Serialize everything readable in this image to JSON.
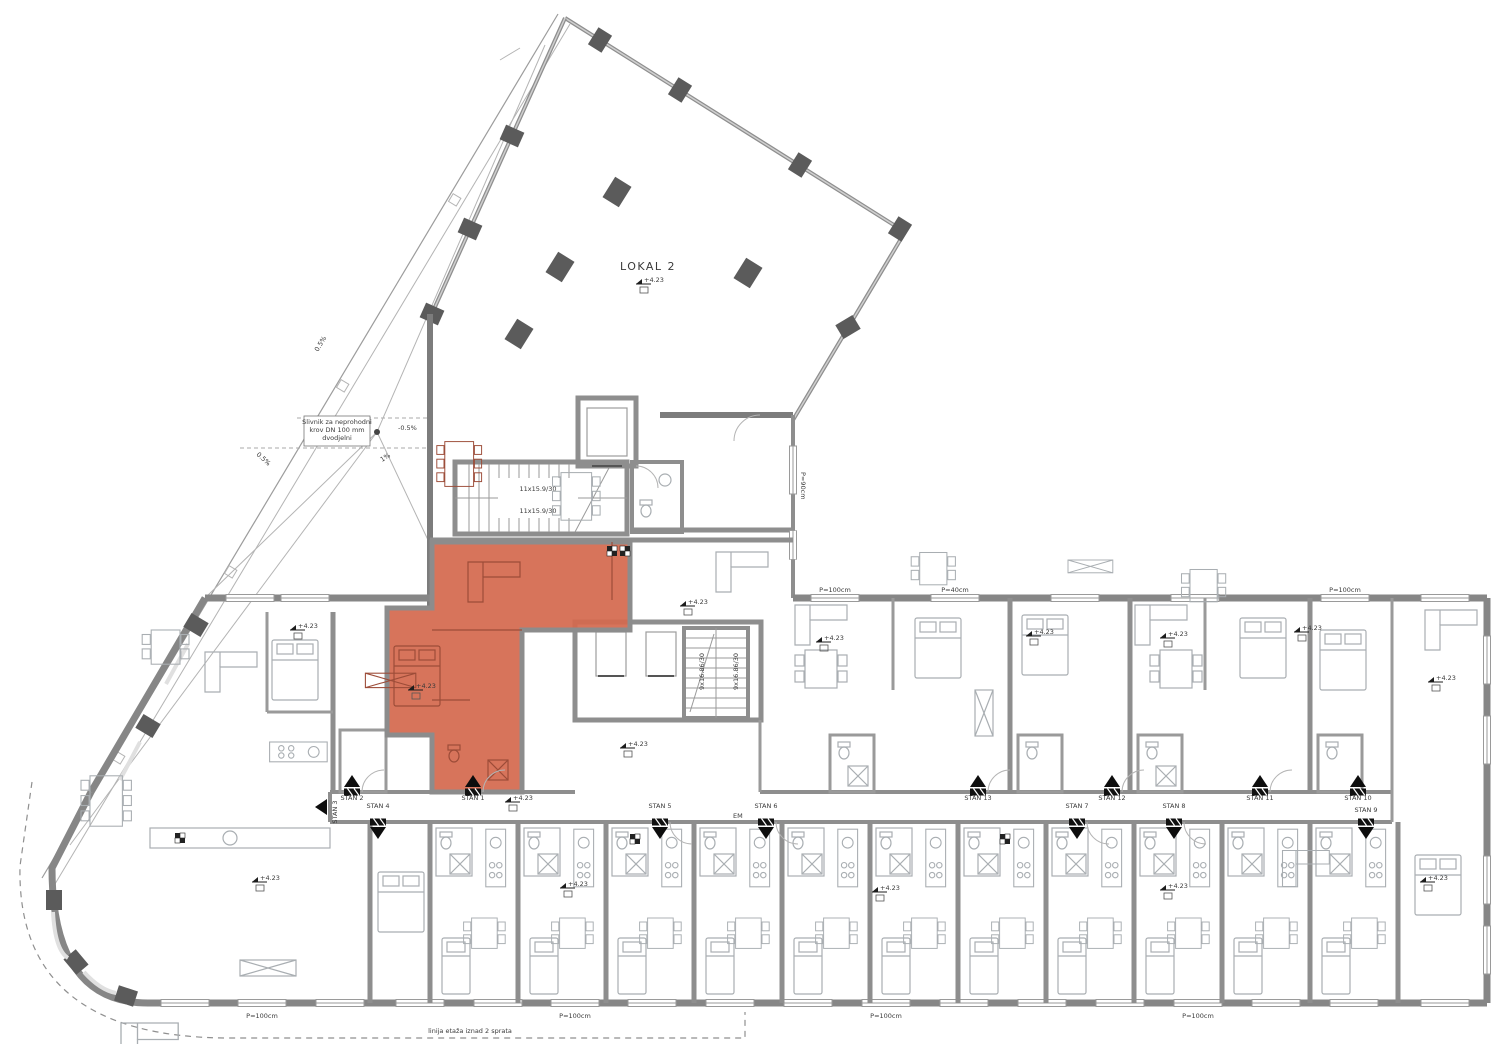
{
  "colors": {
    "highlight": "#d4694f",
    "highlight_stroke": "#b04a33",
    "wall": "#868686",
    "column": "#5b5b5b",
    "furniture_line": "#a9aeb2",
    "text": "#3a3a3a"
  },
  "labels": {
    "lokal2": "LOKAL 2",
    "level": "+4.23",
    "stair_upper": "11x15.9/30",
    "stair_lower": "9x16.86/30",
    "parapet100": "P=100cm",
    "parapet90": "P=90cm",
    "parapet40": "P=40cm",
    "em": "EM",
    "floor_note": "linija etaža iznad 2 sprata",
    "drain_note_1": "Slivnik za neprohodni",
    "drain_note_2": "krov DN 100 mm",
    "drain_note_3": "dvodjelni",
    "slope_a": "0.5%",
    "slope_b": "-0.5%",
    "slope_c": "1%"
  },
  "stans": [
    {
      "label": "STAN 1"
    },
    {
      "label": "STAN 2"
    },
    {
      "label": "STAN 3"
    },
    {
      "label": "STAN 4"
    },
    {
      "label": "STAN 5"
    },
    {
      "label": "STAN 6"
    },
    {
      "label": "STAN 7"
    },
    {
      "label": "STAN 8"
    },
    {
      "label": "STAN 9"
    },
    {
      "label": "STAN 10"
    },
    {
      "label": "STAN 11"
    },
    {
      "label": "STAN 12"
    },
    {
      "label": "STAN 13"
    }
  ]
}
